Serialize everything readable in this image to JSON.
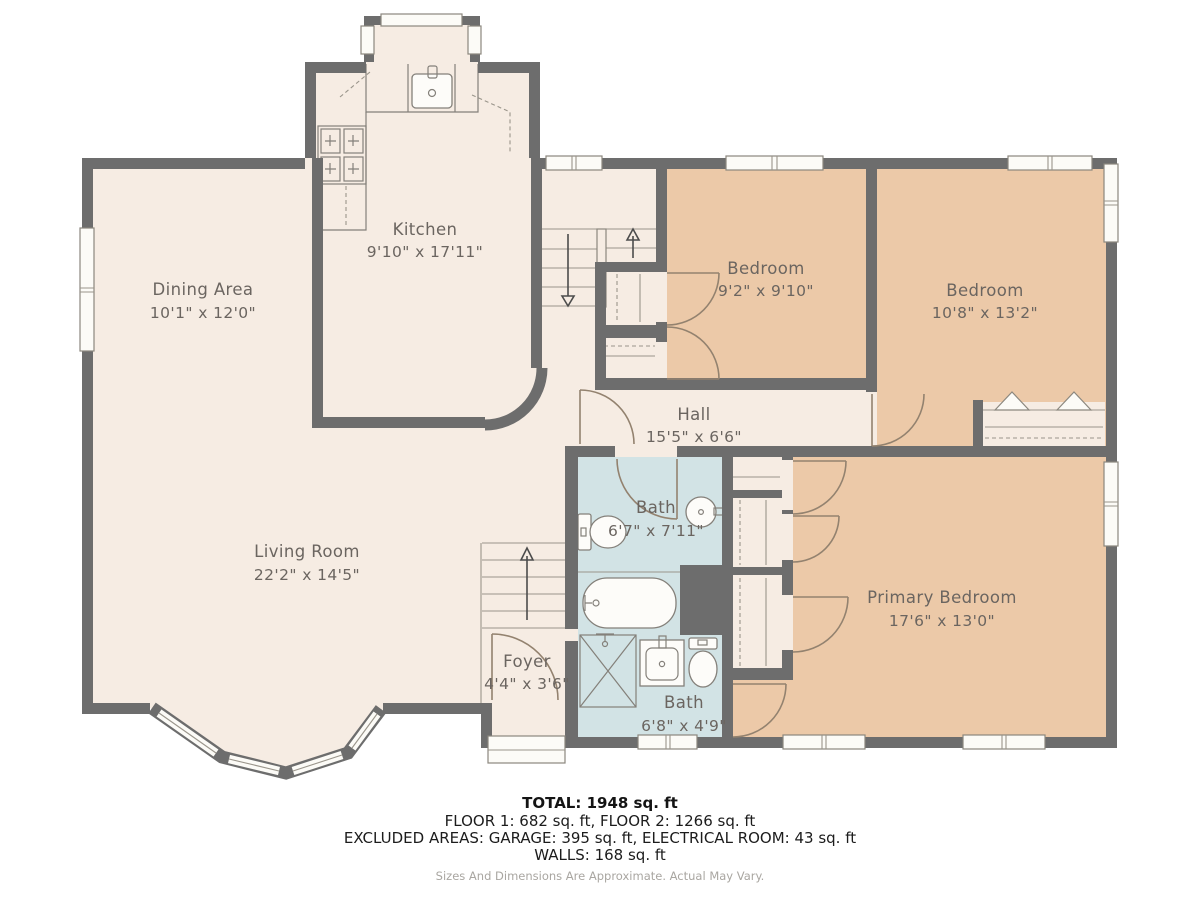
{
  "plan": {
    "rooms": {
      "kitchen": {
        "name": "Kitchen",
        "dims": "9'10\" x 17'11\""
      },
      "dining": {
        "name": "Dining Area",
        "dims": "10'1\" x 12'0\""
      },
      "living": {
        "name": "Living Room",
        "dims": "22'2\" x 14'5\""
      },
      "foyer": {
        "name": "Foyer",
        "dims": "4'4\" x 3'6\""
      },
      "hall": {
        "name": "Hall",
        "dims": "15'5\" x 6'6\""
      },
      "bedroom1": {
        "name": "Bedroom",
        "dims": "9'2\" x 9'10\""
      },
      "bedroom2": {
        "name": "Bedroom",
        "dims": "10'8\" x 13'2\""
      },
      "primary": {
        "name": "Primary Bedroom",
        "dims": "17'6\" x 13'0\""
      },
      "bath1": {
        "name": "Bath",
        "dims": "6'7\" x 7'11\""
      },
      "bath2": {
        "name": "Bath",
        "dims": "6'8\" x 4'9\""
      }
    },
    "summary": {
      "total": "TOTAL: 1948 sq. ft",
      "floors": "FLOOR 1: 682 sq. ft, FLOOR 2: 1266 sq. ft",
      "excluded": "EXCLUDED AREAS: GARAGE: 395 sq. ft, ELECTRICAL ROOM: 43 sq. ft",
      "walls": "WALLS: 168 sq. ft",
      "disclaimer": "Sizes And Dimensions Are Approximate. Actual May Vary."
    },
    "colors": {
      "bedroom_fill": "#ecc9a8",
      "floor_fill": "#f6ece3",
      "bath_fill": "#d2e3e5",
      "wall_gray": "#6d6d6d"
    }
  }
}
